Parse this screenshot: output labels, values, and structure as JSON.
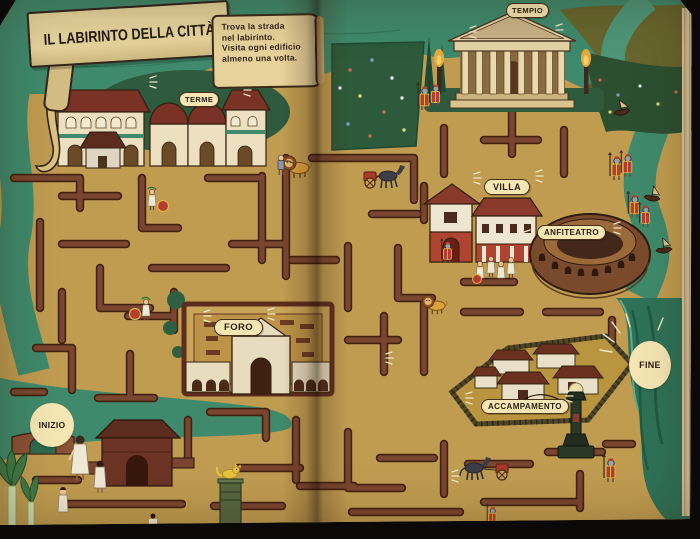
{
  "page": {
    "title": "IL LABIRINTO DELLA CITTÀ",
    "instructions": [
      "Trova la strada",
      "nel labirinto.",
      "Visita ogni edificio",
      "almeno una volta."
    ]
  },
  "labels": {
    "tempio": "TEMPIO",
    "terme": "TERME",
    "villa": "VILLA",
    "anfiteatro": "ANFITEATRO",
    "foro": "FORO",
    "accampamento": "ACCAMPAMENTO"
  },
  "markers": {
    "start": "INIZIO",
    "end": "FINE"
  },
  "colors": {
    "ground": "#bf9c50",
    "maze_wall": "#79462f",
    "maze_wall_outline": "#42200f",
    "river": "#3f8a6c",
    "dark_foliage": "#2e5a3d",
    "label_background": "#f6e6b4",
    "label_text": "#2d2012",
    "roof_maroon": "#7a3226",
    "accent_red": "#b04432",
    "banner": "#e0cd93"
  },
  "figures": [
    "roman-soldier",
    "lion",
    "gladiator",
    "horse-and-chariot",
    "toga-figures",
    "children",
    "cat",
    "boat",
    "bridge",
    "torch-flame",
    "cypress-tree",
    "street-lamp",
    "plant"
  ]
}
